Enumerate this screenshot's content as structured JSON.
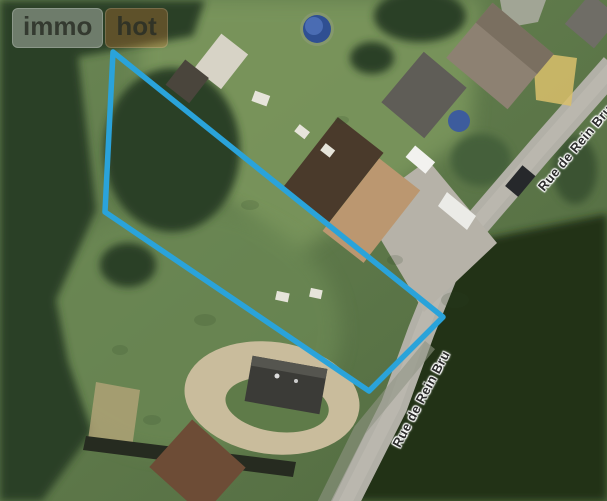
{
  "watermark": {
    "brand_primary": "immo",
    "brand_secondary": "hot",
    "accent_color": "#d97a33"
  },
  "map": {
    "imagery": "satellite",
    "street_labels": [
      {
        "text": "Rue de Rein Bru"
      },
      {
        "text": "Rue de Rein Bru"
      }
    ],
    "parcel_outline": {
      "points": "113,52 443,317 369,391 105,212",
      "stroke_color": "#2aa3da"
    }
  }
}
